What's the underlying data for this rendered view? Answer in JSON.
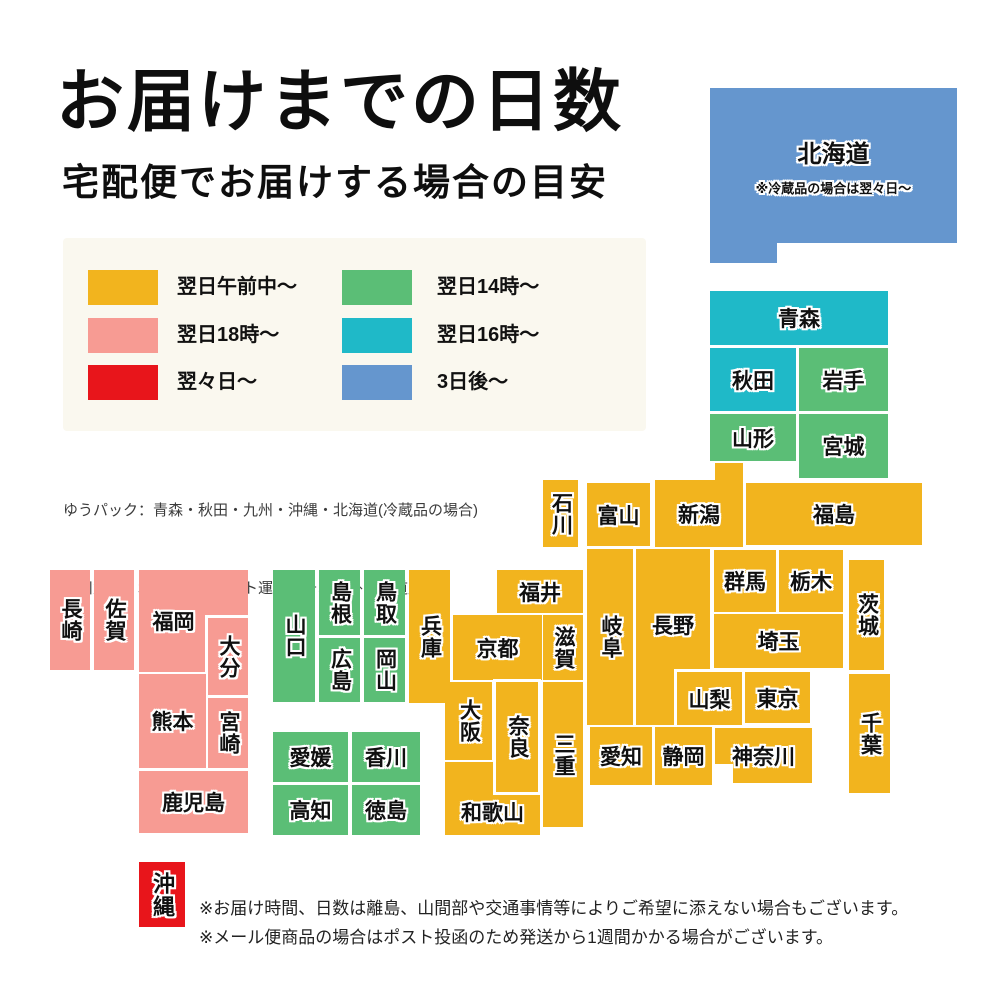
{
  "title": "お届けまでの日数",
  "subtitle": "宅配便でお届けする場合の目安",
  "legend": {
    "panel_bg": "#faf8ef",
    "items": [
      {
        "label": "翌日午前中〜",
        "key": "morning",
        "color": "#f2b41e"
      },
      {
        "label": "翌日18時〜",
        "key": "next18",
        "color": "#f79b93"
      },
      {
        "label": "翌々日〜",
        "key": "afternext",
        "color": "#e8151b"
      },
      {
        "label": "翌日14時〜",
        "key": "next14",
        "color": "#5bbe76"
      },
      {
        "label": "翌日16時〜",
        "key": "next16",
        "color": "#1fb9c8"
      },
      {
        "label": "3日後〜",
        "key": "after3",
        "color": "#6596ce"
      }
    ]
  },
  "carrier_notes": {
    "line1": "ゆうパック：青森・秋田・九州・沖縄・北海道(冷蔵品の場合)",
    "line2": "佐川急便：北海道　　ヤマト運輸：それ以外の都道府県"
  },
  "footer_notes": {
    "line1": "※お届け時間、日数は離島、山間部や交通事情等によりご希望に添えない場合もございます。",
    "line2": "※メール便商品の場合はポスト投函のため発送から1週間かかる場合がございます。"
  },
  "map": {
    "palette": {
      "morning": "#f2b41e",
      "next18": "#f79b93",
      "afternext": "#e8151b",
      "next14": "#5bbe76",
      "next16": "#1fb9c8",
      "after3": "#6596ce"
    },
    "prefectures": [
      {
        "id": "hokkaido",
        "name": "北海道",
        "key": "after3",
        "rect": [
          710,
          88,
          247,
          155
        ],
        "fs": 24,
        "note": "※冷蔵品の場合は翌々日〜",
        "parts": [
          [
            710,
            238,
            67,
            25
          ]
        ]
      },
      {
        "id": "aomori",
        "name": "青森",
        "key": "next16",
        "rect": [
          710,
          291,
          178,
          54
        ]
      },
      {
        "id": "akita",
        "name": "秋田",
        "key": "next16",
        "rect": [
          710,
          348,
          86,
          63
        ]
      },
      {
        "id": "iwate",
        "name": "岩手",
        "key": "next14",
        "rect": [
          799,
          348,
          89,
          63
        ]
      },
      {
        "id": "yamagata",
        "name": "山形",
        "key": "next14",
        "rect": [
          710,
          414,
          86,
          47
        ]
      },
      {
        "id": "miyagi",
        "name": "宮城",
        "key": "next14",
        "rect": [
          799,
          414,
          89,
          64
        ]
      },
      {
        "id": "niigata",
        "name": "新潟",
        "key": "morning",
        "rect": [
          655,
          480,
          88,
          67
        ],
        "parts": [
          [
            715,
            463,
            28,
            20
          ]
        ]
      },
      {
        "id": "ishikawa",
        "name": "石川",
        "key": "morning",
        "rect": [
          543,
          480,
          35,
          67
        ],
        "v": true
      },
      {
        "id": "toyama",
        "name": "富山",
        "key": "morning",
        "rect": [
          587,
          483,
          63,
          63
        ]
      },
      {
        "id": "fukushima",
        "name": "福島",
        "key": "morning",
        "rect": [
          746,
          483,
          176,
          62
        ]
      },
      {
        "id": "fukui",
        "name": "福井",
        "key": "morning",
        "rect": [
          497,
          570,
          86,
          43
        ]
      },
      {
        "id": "gifu",
        "name": "岐阜",
        "key": "morning",
        "rect": [
          587,
          549,
          46,
          176
        ],
        "v": true
      },
      {
        "id": "nagano",
        "name": "長野",
        "key": "morning",
        "rect": [
          636,
          549,
          74,
          176
        ],
        "pad": "0 0 24px 0"
      },
      {
        "id": "gunma",
        "name": "群馬",
        "key": "morning",
        "rect": [
          714,
          550,
          62,
          62
        ]
      },
      {
        "id": "tochigi",
        "name": "栃木",
        "key": "morning",
        "rect": [
          779,
          550,
          64,
          62
        ]
      },
      {
        "id": "ibaraki",
        "name": "茨城",
        "key": "morning",
        "rect": [
          849,
          560,
          35,
          110
        ],
        "v": true
      },
      {
        "id": "saitama",
        "name": "埼玉",
        "key": "morning",
        "rect": [
          714,
          614,
          129,
          54
        ]
      },
      {
        "id": "yamanashi",
        "name": "山梨",
        "key": "morning",
        "rect": [
          677,
          672,
          65,
          53
        ],
        "bordered": true
      },
      {
        "id": "tokyo",
        "name": "東京",
        "key": "morning",
        "rect": [
          745,
          672,
          65,
          51
        ]
      },
      {
        "id": "chiba",
        "name": "千葉",
        "key": "morning",
        "rect": [
          849,
          674,
          41,
          119
        ],
        "v": true
      },
      {
        "id": "kanagawa",
        "name": "神奈川",
        "key": "morning",
        "rect": [
          715,
          728,
          97,
          55
        ],
        "white_parts": [
          [
            715,
            764,
            18,
            19
          ]
        ]
      },
      {
        "id": "shizuoka",
        "name": "静岡",
        "key": "morning",
        "rect": [
          655,
          727,
          57,
          58
        ]
      },
      {
        "id": "aichi",
        "name": "愛知",
        "key": "morning",
        "rect": [
          590,
          727,
          62,
          58
        ]
      },
      {
        "id": "kyoto",
        "name": "京都",
        "key": "morning",
        "rect": [
          453,
          615,
          89,
          65
        ]
      },
      {
        "id": "shiga",
        "name": "滋賀",
        "key": "morning",
        "rect": [
          543,
          615,
          40,
          65
        ],
        "v": true
      },
      {
        "id": "hyogo",
        "name": "兵庫",
        "key": "morning",
        "rect": [
          409,
          570,
          41,
          133
        ],
        "v": true
      },
      {
        "id": "mie",
        "name": "三重",
        "key": "morning",
        "rect": [
          543,
          682,
          40,
          145
        ],
        "v": true
      },
      {
        "id": "osaka",
        "name": "大阪",
        "key": "morning",
        "rect": [
          445,
          682,
          47,
          78
        ],
        "v": true
      },
      {
        "id": "wakayama",
        "name": "和歌山",
        "key": "morning",
        "rect": [
          445,
          762,
          95,
          73
        ],
        "pad": "26px 0 0 0"
      },
      {
        "id": "nara",
        "name": "奈良",
        "key": "morning",
        "rect": [
          496,
          682,
          42,
          110
        ],
        "v": true,
        "bordered": true
      },
      {
        "id": "yamaguchi",
        "name": "山口",
        "key": "next14",
        "rect": [
          273,
          570,
          42,
          132
        ],
        "v": true
      },
      {
        "id": "shimane",
        "name": "島根",
        "key": "next14",
        "rect": [
          319,
          570,
          41,
          65
        ],
        "v": true
      },
      {
        "id": "hiroshima",
        "name": "広島",
        "key": "next14",
        "rect": [
          319,
          638,
          41,
          64
        ],
        "v": true
      },
      {
        "id": "tottori",
        "name": "鳥取",
        "key": "next14",
        "rect": [
          364,
          570,
          41,
          65
        ],
        "v": true
      },
      {
        "id": "okayama",
        "name": "岡山",
        "key": "next14",
        "rect": [
          364,
          638,
          41,
          64
        ],
        "v": true
      },
      {
        "id": "ehime",
        "name": "愛媛",
        "key": "next14",
        "rect": [
          273,
          732,
          75,
          50
        ]
      },
      {
        "id": "kagawa",
        "name": "香川",
        "key": "next14",
        "rect": [
          352,
          732,
          68,
          50
        ]
      },
      {
        "id": "kochi",
        "name": "高知",
        "key": "next14",
        "rect": [
          273,
          785,
          75,
          50
        ]
      },
      {
        "id": "tokushima",
        "name": "徳島",
        "key": "next14",
        "rect": [
          352,
          785,
          68,
          50
        ]
      },
      {
        "id": "nagasaki",
        "name": "長崎",
        "key": "next18",
        "rect": [
          50,
          570,
          40,
          100
        ],
        "v": true
      },
      {
        "id": "saga",
        "name": "佐賀",
        "key": "next18",
        "rect": [
          94,
          570,
          40,
          100
        ],
        "v": true
      },
      {
        "id": "fukuoka",
        "name": "福岡",
        "key": "next18",
        "rect": [
          139,
          570,
          109,
          102
        ],
        "pad": "0 40px 0 0"
      },
      {
        "id": "oita",
        "name": "大分",
        "key": "next18",
        "rect": [
          208,
          618,
          40,
          77
        ],
        "v": true,
        "bordered": true
      },
      {
        "id": "kumamoto",
        "name": "熊本",
        "key": "next18",
        "rect": [
          139,
          674,
          67,
          94
        ]
      },
      {
        "id": "miyazaki",
        "name": "宮崎",
        "key": "next18",
        "rect": [
          208,
          698,
          40,
          70
        ],
        "v": true
      },
      {
        "id": "kagoshima",
        "name": "鹿児島",
        "key": "next18",
        "rect": [
          139,
          771,
          109,
          62
        ]
      },
      {
        "id": "okinawa",
        "name": "沖縄",
        "key": "afternext",
        "rect": [
          139,
          862,
          46,
          65
        ],
        "v": true,
        "fs": 22
      }
    ]
  }
}
